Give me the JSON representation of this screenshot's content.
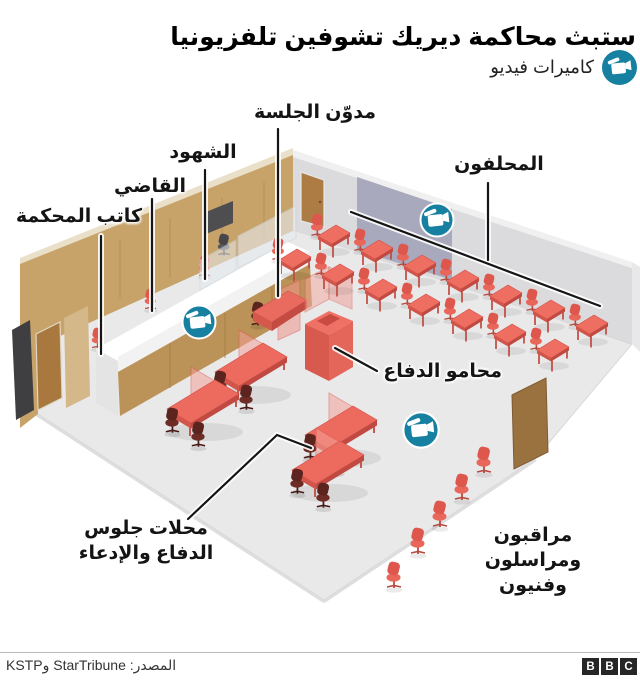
{
  "title": "ستبث محاكمة ديريك تشوفين تلفزيونيا",
  "legend": {
    "label": "كاميرات فيديو"
  },
  "room": {
    "labels": {
      "reporter": "مدوّن الجلسة",
      "witnesses": "الشهود",
      "judge": "القاضي",
      "clerk": "كاتب المحكمة",
      "jurors": "المحلفون",
      "defense_lawyers": "محامو الدفاع",
      "seating_line1": "محلات جلوس",
      "seating_line2": "الدفاع والإدعاء",
      "observers_line1": "مراقبون",
      "observers_line2": "ومراسلون وفنيون"
    },
    "camera_count": 3
  },
  "footer": {
    "source": "المصدر: StarTribune وKSTP",
    "logo_letters": [
      "B",
      "B",
      "C"
    ]
  },
  "colors": {
    "camera_badge": "#15809f",
    "furniture_red": "#ec6a5e",
    "dark_chair": "#5c241f",
    "wall_tan": "#c7a269",
    "wall_gray": "#dbdbdd",
    "wall_purple": "#a8a9bc",
    "floor": "#e9e9ea"
  }
}
